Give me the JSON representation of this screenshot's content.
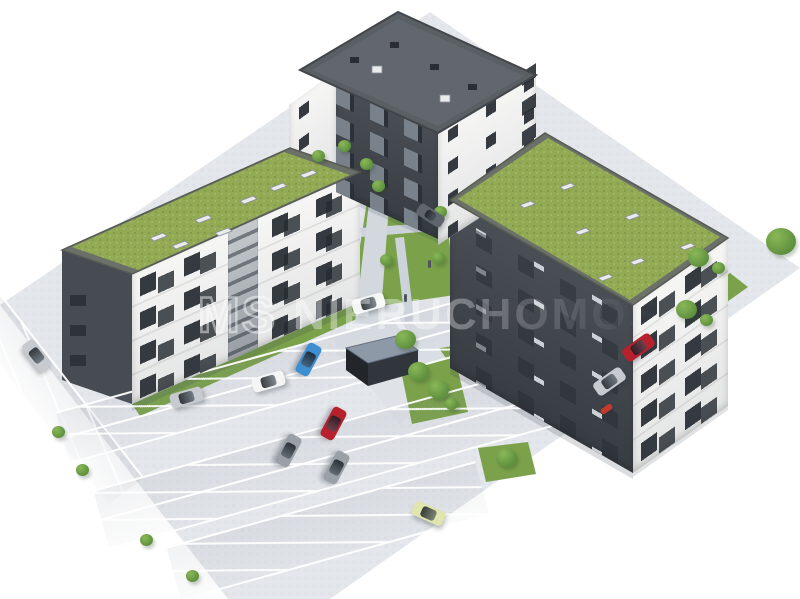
{
  "meta": {
    "title": "Residential estate – aerial 3D visualization",
    "description": "Aerial 3D rendering of a housing estate: three multi-family apartment blocks (two with extensive green roofs and skylights, one with a dark flat roof), white facades with anthracite balcony stacks, an inner courtyard with lawn, sand playground, paths and young trees, a waste shelter, and large surface parking lots with white-marked stalls. Image fades to white at the corners.",
    "canvas": {
      "width": 800,
      "height": 599
    }
  },
  "watermark": {
    "logo_text": "MS",
    "brand_text": "NIERUCHOMOŚCI",
    "style": "semi-transparent white overlay across centre of image"
  },
  "palette": {
    "background": "#ffffff",
    "pavement": "#e4e7eb",
    "pavement-shade": "#dfe3e8",
    "path": "#cdd3da",
    "road": "#d2d8de",
    "marking": "#ffffff",
    "lawn": "#7ba24b",
    "grass-roof": "#93aa55",
    "grass-roof-dark": "#7e9647",
    "grass-roof-light": "#a3b966",
    "parapet": "#6b7069",
    "facade-white": "#f2f3f2",
    "facade-dark": "#41454c",
    "roof-dark": "#5a5f64",
    "window-dark": "#343a40",
    "balcony-glass": "#79828b",
    "sand": "#d9c59c",
    "shed-roof": "#8d99a6",
    "shed-front": "#31363c",
    "shed-side": "#22262b",
    "tree": "#5e8f3d",
    "tree-light": "#8ab858",
    "car-white": "#f4f5f5",
    "car-silver": "#c7cbcf",
    "car-gray": "#9aa0a6",
    "car-dark": "#5f656b",
    "car-blue": "#3e8ed0",
    "car-red": "#b7212e",
    "car-yellow": "#dfe5ac",
    "moto-red": "#c23a2e",
    "watermark": "rgba(255,255,255,0.45)"
  },
  "scene": {
    "buildings": [
      {
        "id": "building-north",
        "position": "top-centre",
        "roof": "dark flat roof with vents and skylights",
        "facade": "anthracite centre section with glass balconies, white gable ends with windows"
      },
      {
        "id": "building-west",
        "position": "left",
        "roof": "extensive green roof with skylights",
        "facade": "white SE facade with balcony stacks and grey stairwell, anthracite end wall"
      },
      {
        "id": "building-east",
        "position": "right",
        "roof": "extensive green roof with skylights",
        "facade": "anthracite courtyard wall with slit windows, white balcony facade on SE side"
      }
    ],
    "courtyard": {
      "features": [
        "lawn",
        "sand playground",
        "paved paths",
        "young trees",
        "waste shelter",
        "parked white car",
        "parked dark car",
        "pedestrians"
      ]
    },
    "parking": {
      "marking_color": "#ffffff",
      "rows": [
        "left edge angled stalls",
        "upper double row",
        "middle double row",
        "lower partial row",
        "east road parallel stalls"
      ],
      "vehicles": [
        {
          "id": "car-white-courtyard",
          "color": "white"
        },
        {
          "id": "car-dark-courtyard",
          "color": "dark gray"
        },
        {
          "id": "car-silver-west-1",
          "color": "silver"
        },
        {
          "id": "car-silver-west-2",
          "color": "silver"
        },
        {
          "id": "car-white-lot",
          "color": "white"
        },
        {
          "id": "car-blue-lot",
          "color": "blue"
        },
        {
          "id": "car-red-lot",
          "color": "red"
        },
        {
          "id": "car-gray-lot-1",
          "color": "gray"
        },
        {
          "id": "car-gray-lot-2",
          "color": "gray"
        },
        {
          "id": "car-yellow-lot",
          "color": "pale yellow"
        },
        {
          "id": "car-red-east",
          "color": "red"
        },
        {
          "id": "car-silver-east",
          "color": "silver"
        },
        {
          "id": "motorcycle-east",
          "color": "red"
        }
      ]
    }
  }
}
